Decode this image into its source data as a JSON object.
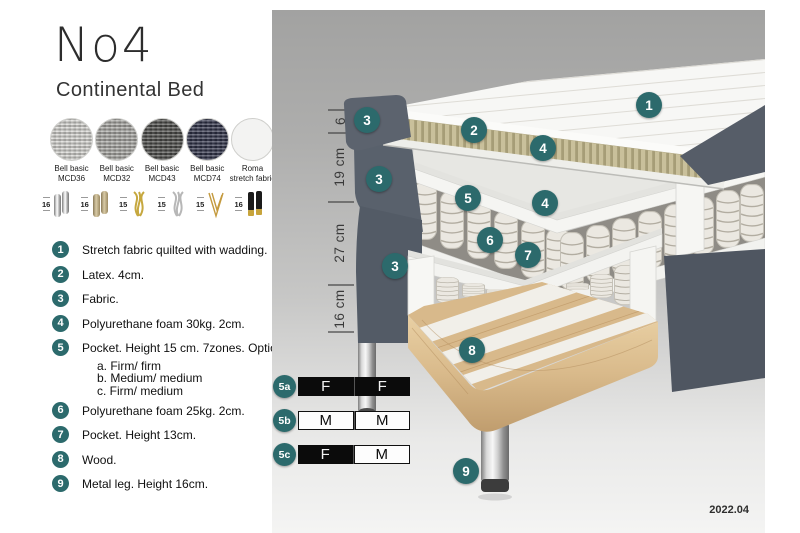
{
  "header": {
    "title": "No4",
    "subtitle": "Continental Bed"
  },
  "fabrics": [
    {
      "line1": "Bell basic",
      "line2": "MCD36",
      "color": "#d7d6d2"
    },
    {
      "line1": "Bell basic",
      "line2": "MCD32",
      "color": "#a9a8a4"
    },
    {
      "line1": "Bell basic",
      "line2": "MCD43",
      "color": "#4c4c4a"
    },
    {
      "line1": "Bell basic",
      "line2": "MCD74",
      "color": "#2f3248"
    },
    {
      "line1": "Roma",
      "line2": "stretch fabric",
      "color": "#f3f3f2"
    }
  ],
  "leg_options": [
    {
      "height": "16",
      "type": "cylinder-chrome-leg-icon"
    },
    {
      "height": "16",
      "type": "cylinder-bronze-leg-icon"
    },
    {
      "height": "15",
      "type": "twisted-gold-leg-icon"
    },
    {
      "height": "15",
      "type": "twisted-silver-leg-icon"
    },
    {
      "height": "15",
      "type": "hairpin-gold-leg-icon"
    },
    {
      "height": "16",
      "type": "cylinder-black-gold-leg-icon"
    }
  ],
  "parts": [
    {
      "num": "1",
      "text": "Stretch fabric quilted with wadding."
    },
    {
      "num": "2",
      "text": "Latex. 4cm."
    },
    {
      "num": "3",
      "text": "Fabric."
    },
    {
      "num": "4",
      "text": "Polyurethane foam 30kg. 2cm."
    },
    {
      "num": "5",
      "text": "Pocket. Height 15 cm. 7zones. Option:",
      "options": [
        "a. Firm/ firm",
        "b. Medium/ medium",
        "c. Firm/ medium"
      ]
    },
    {
      "num": "6",
      "text": "Polyurethane foam 25kg. 2cm."
    },
    {
      "num": "7",
      "text": "Pocket. Height 13cm."
    },
    {
      "num": "8",
      "text": "Wood."
    },
    {
      "num": "9",
      "text": "Metal leg. Height 16cm."
    }
  ],
  "diagram": {
    "dim_labels": [
      "6",
      "19 cm",
      "27 cm",
      "16 cm"
    ],
    "callouts": {
      "c1": "1",
      "c2": "2",
      "c3": "3",
      "c4": "4",
      "c5": "5",
      "c6": "6",
      "c7": "7",
      "c8": "8",
      "c9": "9"
    }
  },
  "firmness_rows": [
    {
      "label": "5a",
      "cells": [
        {
          "letter": "F",
          "css": "fcell dark"
        },
        {
          "letter": "F",
          "css": "fcell dark"
        }
      ]
    },
    {
      "label": "5b",
      "cells": [
        {
          "letter": "M",
          "css": "fcell light"
        },
        {
          "letter": "M",
          "css": "fcell light"
        }
      ]
    },
    {
      "label": "5c",
      "cells": [
        {
          "letter": "F",
          "css": "fcell dark"
        },
        {
          "letter": "M",
          "css": "fcell light"
        }
      ]
    }
  ],
  "version": "2022.04",
  "colors": {
    "accent_teal": "#2c6a6c",
    "fabric_dark": "#59616c",
    "latex": "#c9c09b",
    "wood": "#d8b98b",
    "spring_white": "#ebe8e1",
    "chrome": "#c6c6c6",
    "background_gray": "#a8a8a7"
  }
}
